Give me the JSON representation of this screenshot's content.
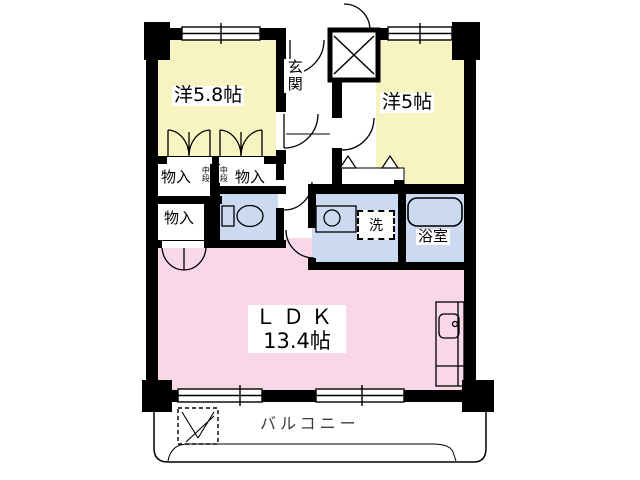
{
  "colors": {
    "wall": "#000000",
    "bedroom_fill": "#F8F4C2",
    "ldk_fill": "#F8D7E7",
    "wet_fill": "#CBD9F1",
    "outline": "#000000",
    "balcony_text": "#3C3C3C"
  },
  "rooms": {
    "bedroom1": {
      "label": "洋5.8帖"
    },
    "bedroom2": {
      "label": "洋5帖"
    },
    "entrance": {
      "label": "玄関"
    },
    "ldk": {
      "label": "ＬＤＫ",
      "size": "13.4帖"
    },
    "storage_top_left": {
      "label": "物入"
    },
    "storage_top_right": {
      "label": "物入"
    },
    "storage_lower": {
      "label": "物入"
    },
    "shelf_left": {
      "label": "中段"
    },
    "shelf_right": {
      "label": "中段"
    },
    "laundry": {
      "label": "洗"
    },
    "bathroom": {
      "label": "浴室"
    },
    "balcony": {
      "label": "バルコニー"
    }
  }
}
